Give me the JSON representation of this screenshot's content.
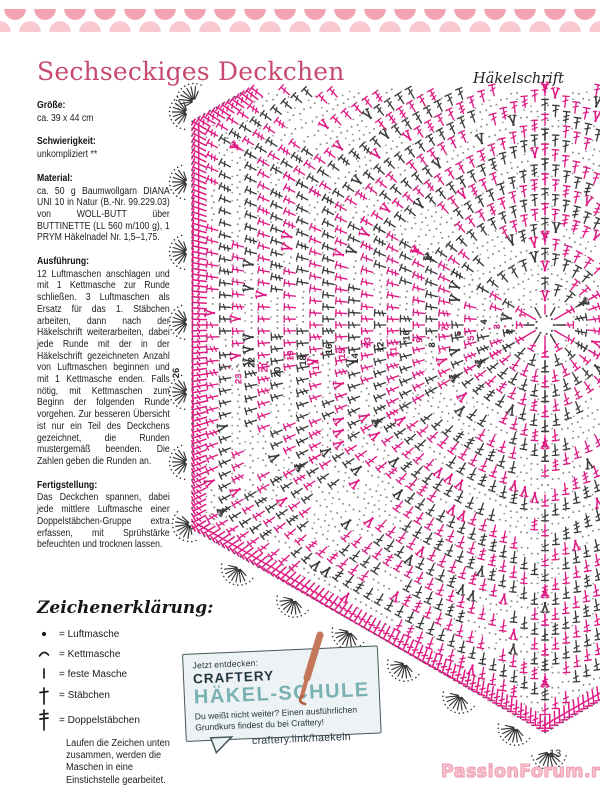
{
  "header": {
    "title": "Sechseckiges Deckchen",
    "right_label": "Häkelschrift"
  },
  "info_sections": [
    {
      "label": "Größe:",
      "text": "ca. 39 x 44 cm"
    },
    {
      "label": "Schwierigkeit:",
      "text": "unkompliziert **"
    },
    {
      "label": "Material:",
      "text": "ca. 50 g Baumwollgarn DIANA UNI 10 in Natur (B.-Nr. 99.229.03) von WOLL-BUTT über BUTTINETTE (LL 560 m/100 g), 1 PRYM Häkelnadel Nr. 1,5–1,75."
    },
    {
      "label": "Ausführung:",
      "text": "12 Luftmaschen anschlagen und mit 1 Kettmasche zur Runde schließen. 3 Luftmaschen als Ersatz für das 1. Stäbchen arbeiten, dann nach der Häkelschrift weiterarbeiten, dabei jede Runde mit der in der Häkelschrift gezeichneten Anzahl von Luftmaschen beginnen und mit 1 Kettmasche enden. Falls nötig, mit Kettmaschen zum Beginn der folgenden Runde vorgehen. Zur besseren Übersicht ist nur ein Teil des Deckchens gezeichnet, die Runden mustergemäß beenden. Die Zahlen geben die Runden an."
    },
    {
      "label": "Fertigstellung:",
      "text": "Das Deckchen spannen, dabei jede mittlere Luftmasche einer Doppelstäbchen-Gruppe extra erfassen, mit Sprühstärke befeuchten und trocknen lassen."
    }
  ],
  "legend": {
    "title": "Zeichenerklärung:",
    "items": [
      {
        "symbol": "luftmasche-dot",
        "label": "= Luftmasche"
      },
      {
        "symbol": "kettmasche-arc",
        "label": "= Kettmasche"
      },
      {
        "symbol": "feste-masche-bar",
        "label": "= feste Masche"
      },
      {
        "symbol": "staebchen-cross",
        "label": "= Stäbchen"
      },
      {
        "symbol": "doppelstaebchen-cross",
        "label": "= Doppelstäbchen"
      }
    ],
    "note": "Laufen die Zeichen unten zusammen, werden die Maschen in eine Einstichstelle gearbeitet."
  },
  "chart": {
    "description": "Häkelschrift – partial hexagonal doily crochet chart, rounds numbered from center outward",
    "center": {
      "x": 545,
      "y": 325
    },
    "rounds": 26,
    "ring0_radius": 11,
    "ring_spacing": 14.9,
    "clip": [
      174,
      90,
      598,
      788
    ],
    "round_numbers": [
      1,
      2,
      3,
      4,
      5,
      6,
      7,
      8,
      9,
      10,
      11,
      12,
      13,
      14,
      15,
      16,
      17,
      18,
      19,
      20,
      21,
      22,
      23
    ],
    "outer_round_number": "26",
    "colors": {
      "odd_round": "#df1a82",
      "even_round": "#3b3b3b",
      "dots": "#8d8d8d",
      "fan": "#333333"
    }
  },
  "promo": {
    "kicker": "Jetzt entdecken:",
    "brand": "CRAFTERY",
    "title": "HÄKEL-SCHULE",
    "body": "Du weißt nicht weiter? Einen ausführlichen Grundkurs findest du bei Craftery!",
    "link": "craftery.link/haekeln",
    "colors": {
      "title": "#7ab1b3",
      "bg": "#edf3f4",
      "text": "#243640",
      "hook": "#c5775a"
    }
  },
  "footer": {
    "page_number": "13",
    "watermark": "PassionForum.ru"
  }
}
